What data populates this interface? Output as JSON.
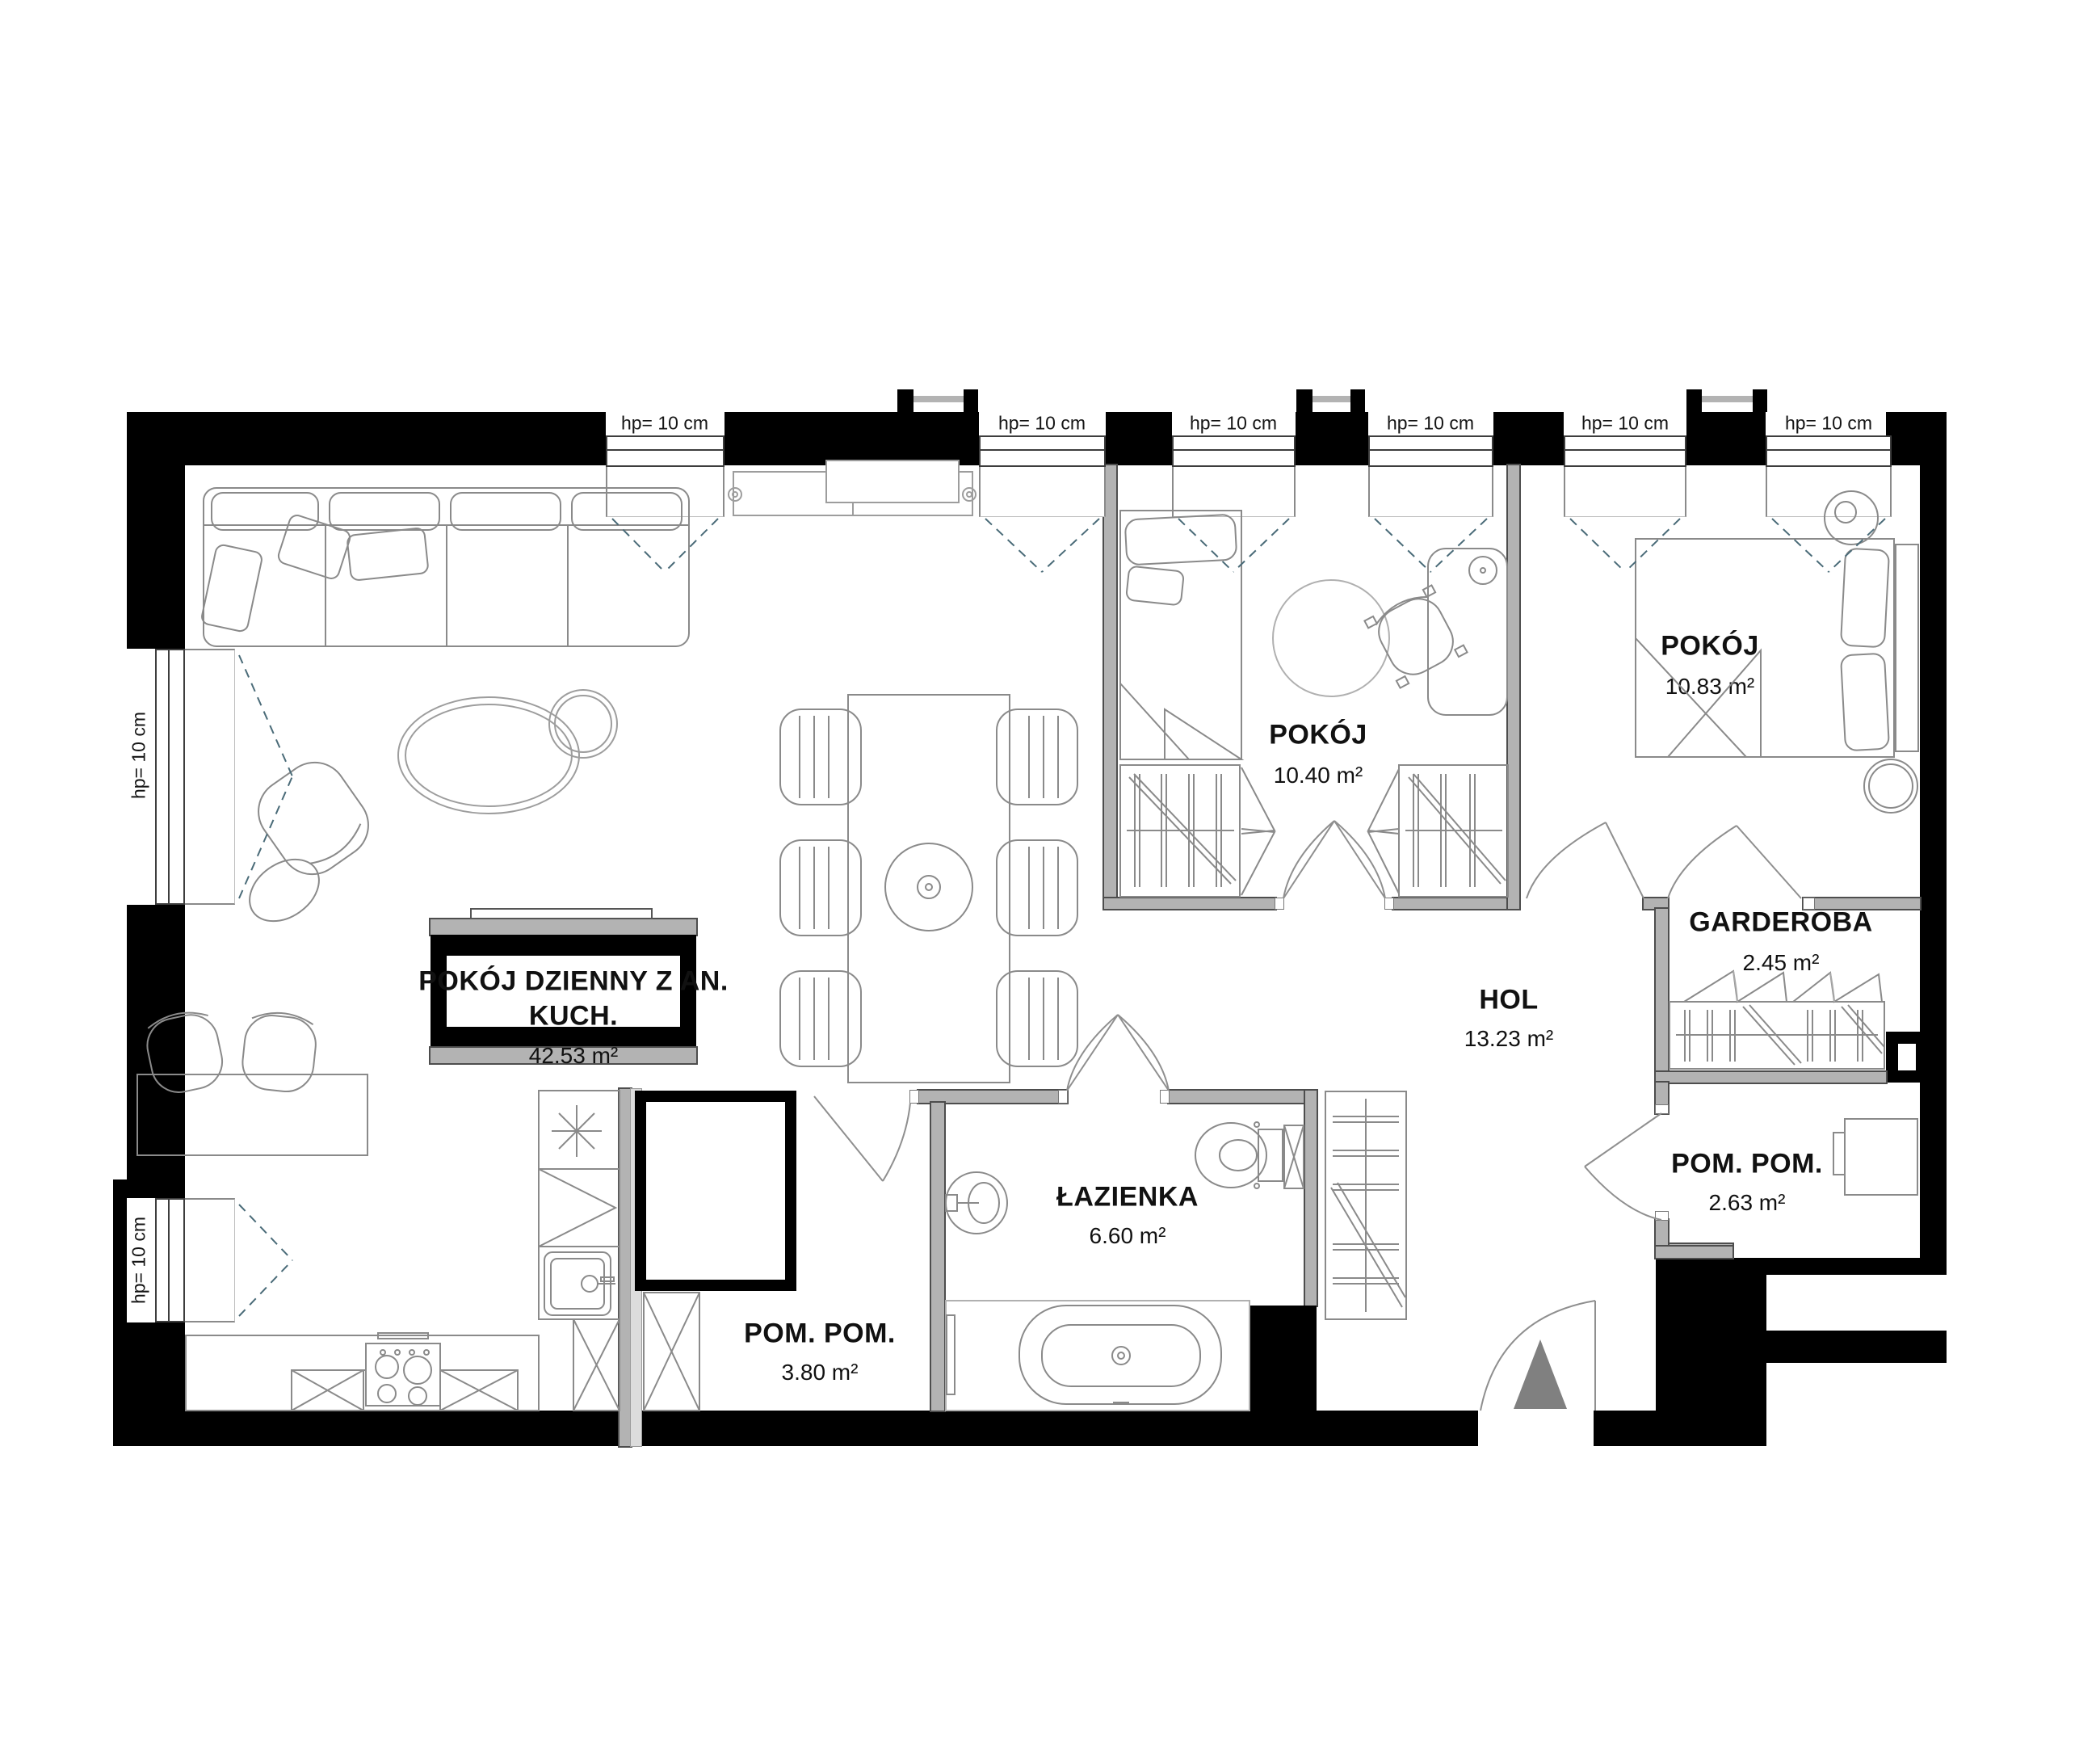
{
  "labels": {
    "window_sill": "hp= 10 cm",
    "ac_unit": "KLIMATYZACJA-SPLIT"
  },
  "rooms": {
    "living": {
      "name_line1": "POKÓJ DZIENNY Z AN.",
      "name_line2": "KUCH.",
      "area": "42.53 m²"
    },
    "room1": {
      "name": "POKÓJ",
      "area": "10.40 m²"
    },
    "room2": {
      "name": "POKÓJ",
      "area": "10.83 m²"
    },
    "garderoba": {
      "name": "GARDEROBA",
      "area": "2.45 m²"
    },
    "hol": {
      "name": "HOL",
      "area": "13.23 m²"
    },
    "pom_small": {
      "name": "POM. POM.",
      "area": "2.63 m²"
    },
    "bathroom": {
      "name": "ŁAZIENKA",
      "area": "6.60 m²"
    },
    "pom_large": {
      "name": "POM. POM.",
      "area": "3.80 m²"
    }
  },
  "colors": {
    "wall": "#000000",
    "partition": "#b3b3b3",
    "furniture_line": "#8a8a8a",
    "swing_dash": "#4a6b78",
    "entrance_marker": "#808080"
  }
}
